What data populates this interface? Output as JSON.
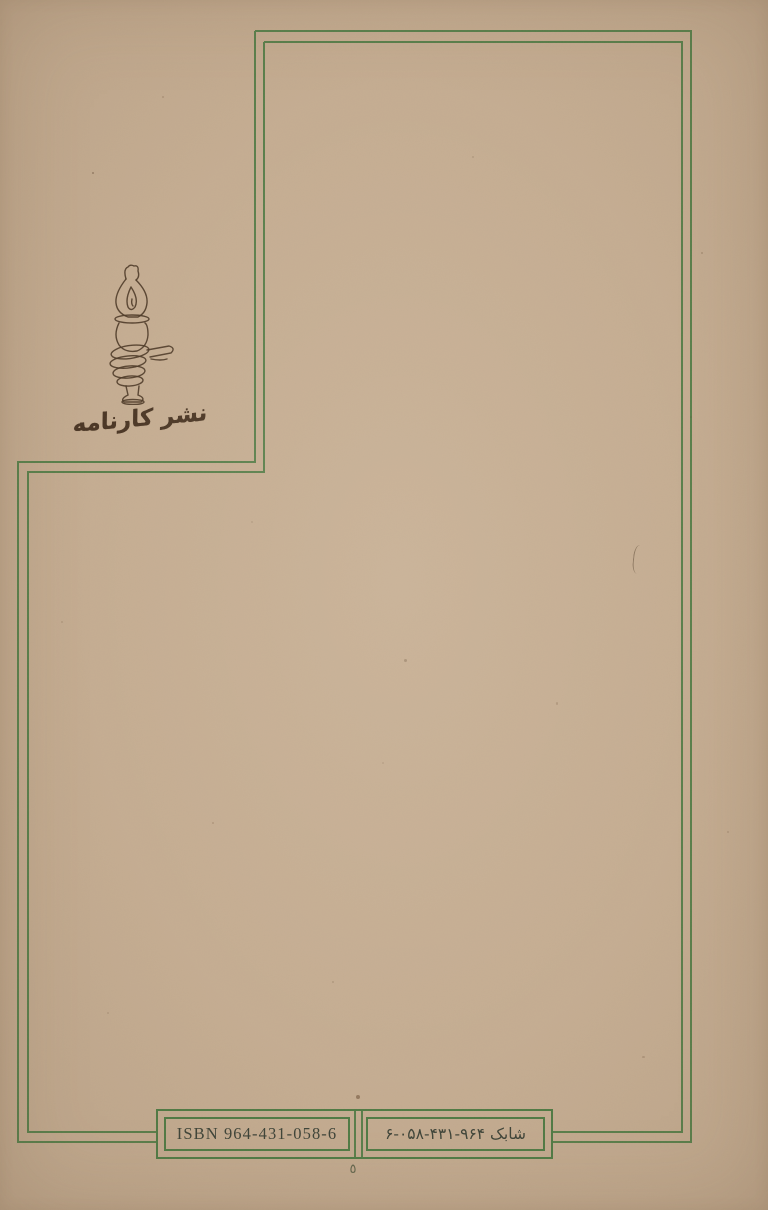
{
  "cover": {
    "publisher_name": "نشر کارنامه",
    "logo_icon": "hand-holding-oil-lamp-icon",
    "isbn_box": {
      "isbn_latin": "ISBN 964-431-058-6",
      "isbn_persian": "شابک ۹۶۴-۴۳۱-۰۵۸-۶"
    },
    "page_number": "٥"
  },
  "colors": {
    "paper": "#c6ae93",
    "frame_green": "#4e7b44",
    "ink_brown": "#4b3827",
    "text_dark": "#3b4237"
  }
}
